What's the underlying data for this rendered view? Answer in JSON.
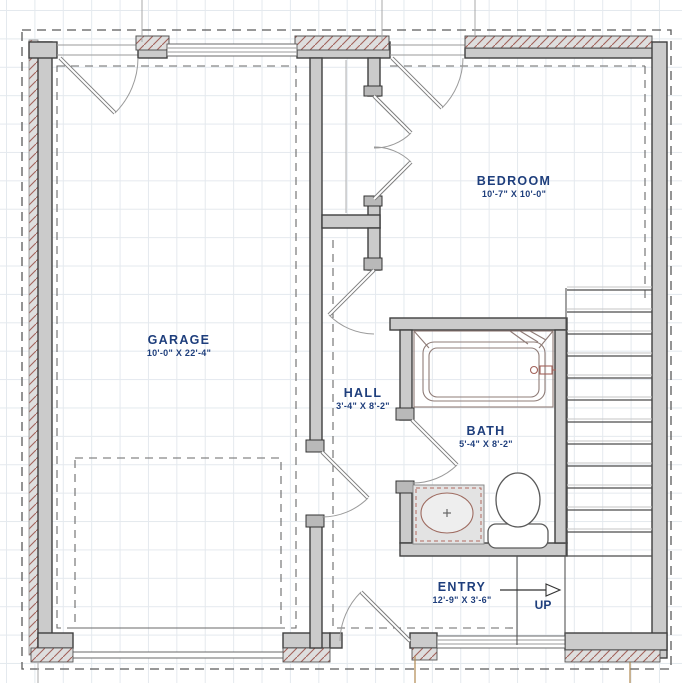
{
  "plan_title": "First floor plan",
  "rooms": {
    "garage": {
      "name": "GARAGE",
      "dims": "10'-0\" X 22'-4\""
    },
    "bedroom": {
      "name": "BEDROOM",
      "dims": "10'-7\" X 10'-0\""
    },
    "hall": {
      "name": "HALL",
      "dims": "3'-4\" X 8'-2\""
    },
    "bath": {
      "name": "BATH",
      "dims": "5'-4\" X 8'-2\""
    },
    "entry": {
      "name": "ENTRY",
      "dims": "12'-9\" X 3'-6\""
    }
  },
  "stairs": {
    "direction_label": "UP"
  },
  "fixtures": [
    "bathtub",
    "toilet",
    "sink-vanity",
    "closet",
    "staircase",
    "garage-door",
    "entry-door"
  ],
  "colors": {
    "label_text": "#1e3e7c",
    "wall_fill": "#cbcbcb",
    "wall_stroke": "#3f3f3f",
    "hatch_line": "#a2625a",
    "grid_line": "#e4e9ee",
    "dashed_line": "#5a5a5a",
    "fixture_line": "#8f7c77",
    "marker_line": "#b08950"
  }
}
